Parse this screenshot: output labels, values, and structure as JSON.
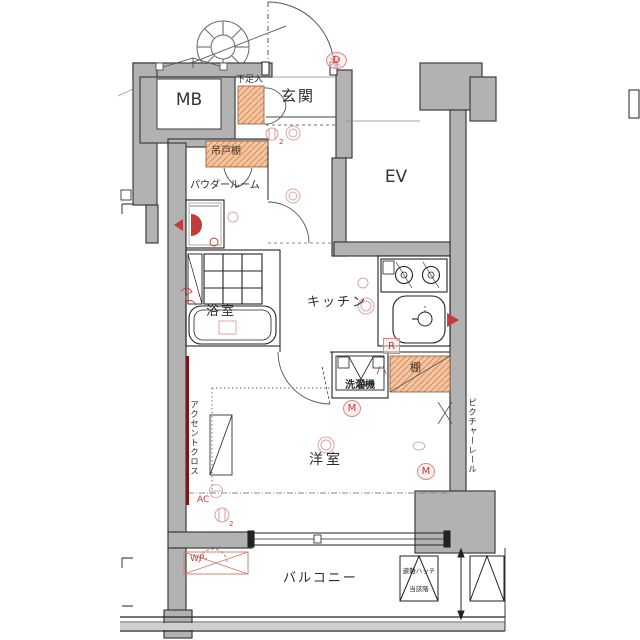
{
  "plan": {
    "rooms": {
      "mb": "MB",
      "genkan": "玄関",
      "ev": "EV",
      "powder": "パウダールーム",
      "bath": "浴室",
      "kitchen": "キッチン",
      "western": "洋室",
      "balcony": "バルコニー"
    },
    "fixtures": {
      "shoe_box": "下足入",
      "hanging_cupboard": "吊戸棚",
      "shelf": "棚",
      "washer": "洗濯機",
      "accent_cloth": "アクセントクロス",
      "picture_rail": "ピクチャーレール",
      "evac_hatch": "避難ハッチ",
      "evac_hatch_floor": "当該階"
    },
    "marks": {
      "d": "D",
      "r": "R",
      "m1": "M",
      "m2": "M",
      "ac": "AC",
      "wp": "WP-",
      "sub2a": "2",
      "sub2b": "2"
    },
    "colors": {
      "wall": "#b2b2b2",
      "hatch_fill": "#f5c5a0",
      "hatch_line": "#d98c5f",
      "red": "#c43b3b",
      "accent_wall": "#7c1618",
      "faint_red": "#dba7a7",
      "line": "#333333"
    }
  }
}
